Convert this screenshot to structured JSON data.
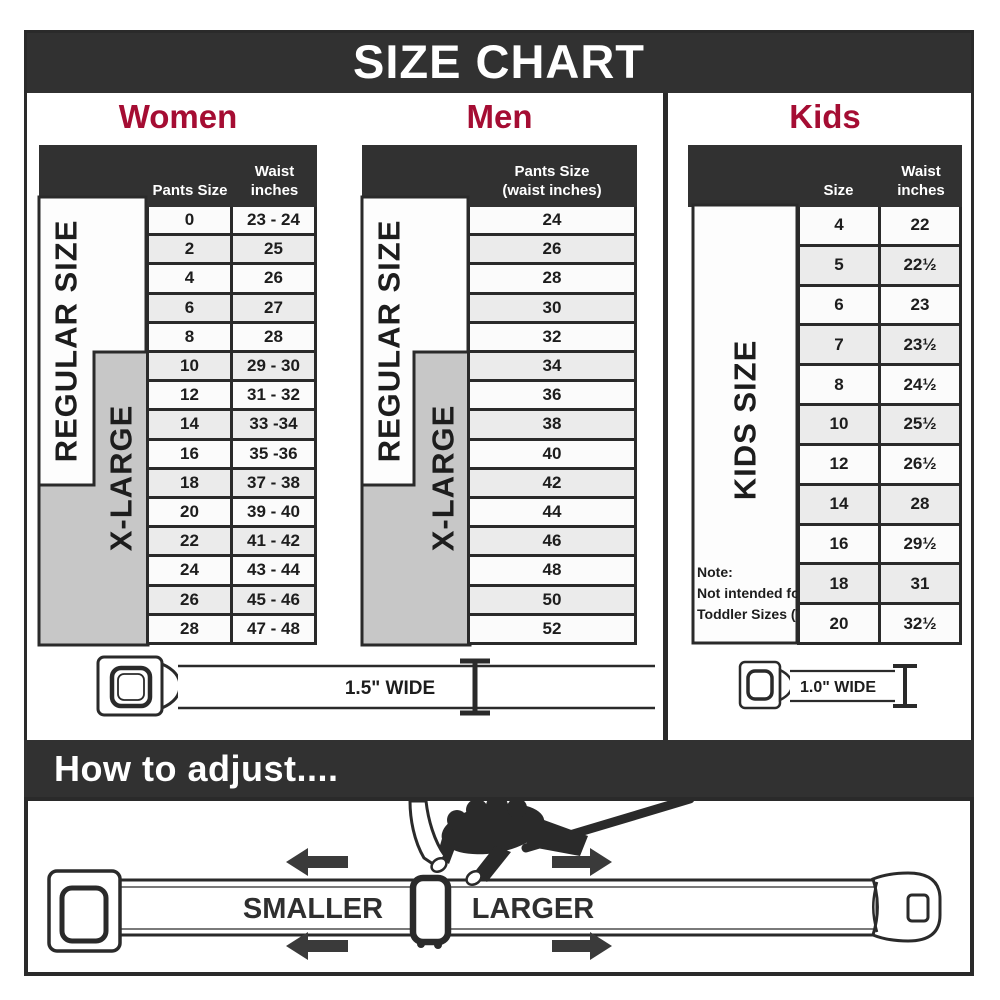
{
  "title": "SIZE CHART",
  "adjust": {
    "heading": "How to adjust....",
    "smaller": "SMALLER",
    "larger": "LARGER"
  },
  "belts": {
    "standard": "1.5\" WIDE",
    "kids": "1.0\" WIDE"
  },
  "sections": {
    "women": {
      "title": "Women",
      "col_pants": "Pants Size",
      "col_waist_1": "Waist",
      "col_waist_2": "inches",
      "regular": "REGULAR SIZE",
      "xlarge": "X-LARGE",
      "rows": [
        {
          "size": "0",
          "waist": "23 - 24"
        },
        {
          "size": "2",
          "waist": "25"
        },
        {
          "size": "4",
          "waist": "26"
        },
        {
          "size": "6",
          "waist": "27"
        },
        {
          "size": "8",
          "waist": "28"
        },
        {
          "size": "10",
          "waist": "29 - 30"
        },
        {
          "size": "12",
          "waist": "31 - 32"
        },
        {
          "size": "14",
          "waist": "33 -34"
        },
        {
          "size": "16",
          "waist": "35 -36"
        },
        {
          "size": "18",
          "waist": "37 - 38"
        },
        {
          "size": "20",
          "waist": "39 - 40"
        },
        {
          "size": "22",
          "waist": "41 - 42"
        },
        {
          "size": "24",
          "waist": "43 - 44"
        },
        {
          "size": "26",
          "waist": "45 - 46"
        },
        {
          "size": "28",
          "waist": "47 - 48"
        }
      ]
    },
    "men": {
      "title": "Men",
      "col_line1": "Pants Size",
      "col_line2": "(waist inches)",
      "regular": "REGULAR SIZE",
      "xlarge": "X-LARGE",
      "rows": [
        "24",
        "26",
        "28",
        "30",
        "32",
        "34",
        "36",
        "38",
        "40",
        "42",
        "44",
        "46",
        "48",
        "50",
        "52"
      ]
    },
    "kids": {
      "title": "Kids",
      "col_size": "Size",
      "col_waist_1": "Waist",
      "col_waist_2": "inches",
      "side": "KIDS SIZE",
      "note_1": "Note:",
      "note_2": "Not intended for",
      "note_3": "Toddler Sizes (T)",
      "rows": [
        {
          "size": "4",
          "waist": "22"
        },
        {
          "size": "5",
          "waist": "22½"
        },
        {
          "size": "6",
          "waist": "23"
        },
        {
          "size": "7",
          "waist": "23½"
        },
        {
          "size": "8",
          "waist": "24½"
        },
        {
          "size": "10",
          "waist": "25½"
        },
        {
          "size": "12",
          "waist": "26½"
        },
        {
          "size": "14",
          "waist": "28"
        },
        {
          "size": "16",
          "waist": "29½"
        },
        {
          "size": "18",
          "waist": "31"
        },
        {
          "size": "20",
          "waist": "32½"
        }
      ]
    }
  },
  "colors": {
    "accent": "#a50d33",
    "dark": "#313131",
    "row_gray": "#ebebeb",
    "xlarge_gray": "#c7c7c7"
  }
}
